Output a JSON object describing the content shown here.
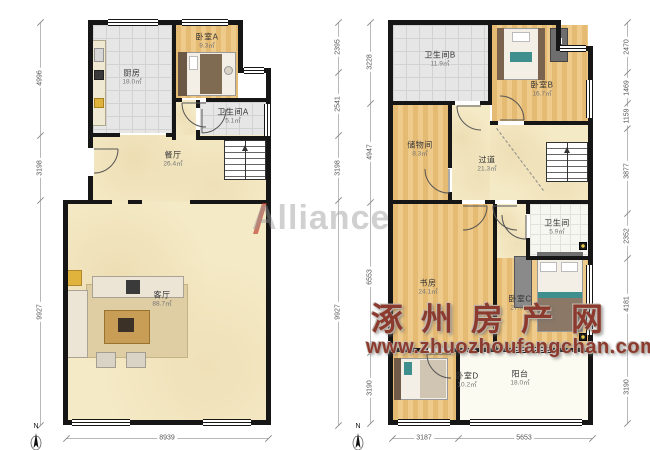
{
  "watermarks": {
    "alliance": "Alliance",
    "site_name": "涿州房产网",
    "site_url": "www.zhuozhoufangchan.com"
  },
  "compass_label": "N",
  "floor1": {
    "rooms": {
      "kitchen": {
        "name": "厨房",
        "area": "18.0㎡"
      },
      "bedroom_a": {
        "name": "卧室A",
        "area": "9.3㎡"
      },
      "bathroom_a": {
        "name": "卫生间A",
        "area": "5.1㎡"
      },
      "dining": {
        "name": "餐厅",
        "area": "26.4㎡"
      },
      "living": {
        "name": "客厅",
        "area": "88.7㎡"
      }
    },
    "dims": {
      "left": [
        "4996",
        "3198",
        "9927"
      ],
      "right": [
        "2395",
        "2541",
        "3198",
        "9927"
      ],
      "bottom": [
        "8939"
      ]
    }
  },
  "floor2": {
    "rooms": {
      "bathroom_b": {
        "name": "卫生间B",
        "area": "11.9㎡"
      },
      "bedroom_b": {
        "name": "卧室B",
        "area": "16.7㎡"
      },
      "storage": {
        "name": "储物间",
        "area": "8.3㎡"
      },
      "hallway": {
        "name": "过道",
        "area": "21.3㎡"
      },
      "bathroom": {
        "name": "卫生间",
        "area": "5.9㎡"
      },
      "study": {
        "name": "书房",
        "area": "24.1㎡"
      },
      "bedroom_c": {
        "name": "卧室C",
        "area": "27.0㎡"
      },
      "bedroom_d": {
        "name": "卧室D",
        "area": "10.2㎡"
      },
      "balcony": {
        "name": "阳台",
        "area": "18.0㎡"
      }
    },
    "dims": {
      "left": [
        "3228",
        "4947",
        "6553",
        "3190"
      ],
      "right": [
        "2470",
        "1469",
        "1159",
        "3877",
        "2352",
        "4181",
        "3190"
      ],
      "bottom": [
        "3187",
        "5653"
      ]
    }
  },
  "colors": {
    "wall": "#161616",
    "wood": "#e9c17b",
    "tile": "#e6e6e6",
    "beige": "#f5eac6",
    "watermark_red": "#8c3a2e"
  }
}
